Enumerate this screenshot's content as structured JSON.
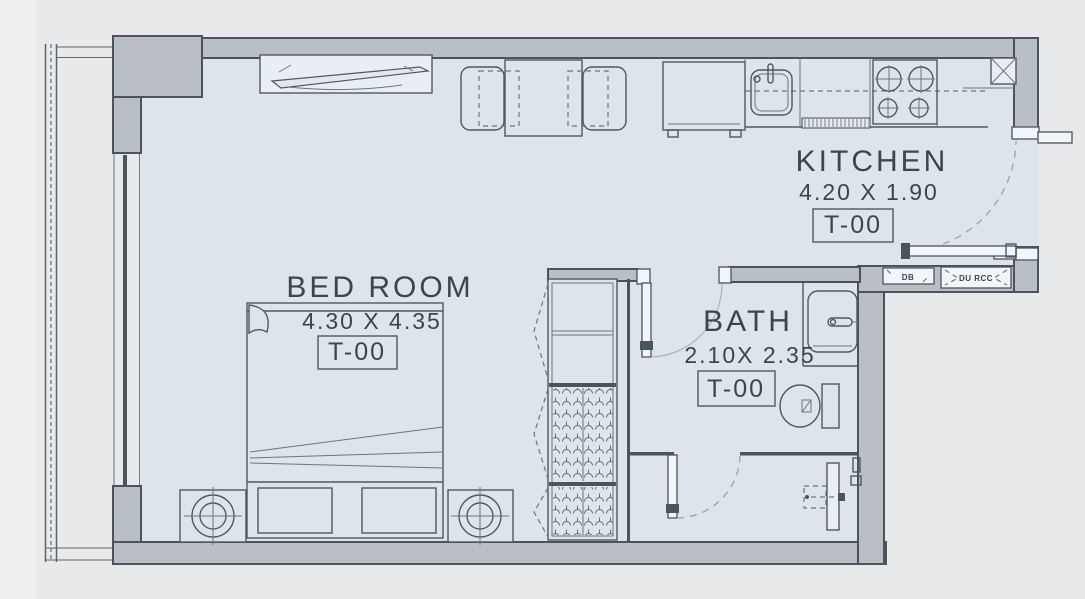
{
  "plan": {
    "rooms": {
      "bedroom": {
        "name": "BED ROOM",
        "dimensions": "4.30 X 4.35",
        "type_code": "T-00"
      },
      "kitchen": {
        "name": "KITCHEN",
        "dimensions": "4.20 X 1.90",
        "type_code": "T-00"
      },
      "bath": {
        "name": "BATH",
        "dimensions": "2.10X 2.35",
        "type_code": "T-00"
      }
    },
    "tags": {
      "db": "DB",
      "du_rcc": "DU RCC"
    },
    "colors": {
      "background": "#e8e9ea",
      "floor": "#dde4ea",
      "wall_fill": "#b9bfc5",
      "outline": "#4a545d",
      "text": "#3b454e"
    },
    "fixtures": [
      "tv-icon",
      "dining-table-icon",
      "chair-icon",
      "refrigerator-icon",
      "sink-icon",
      "cooktop-icon",
      "shaft-icon",
      "double-bed-icon",
      "nightstand-icon",
      "table-lamp-icon",
      "wardrobe-icon",
      "washbasin-icon",
      "toilet-icon",
      "shower-icon",
      "door-icon",
      "balcony-railing-icon"
    ]
  }
}
